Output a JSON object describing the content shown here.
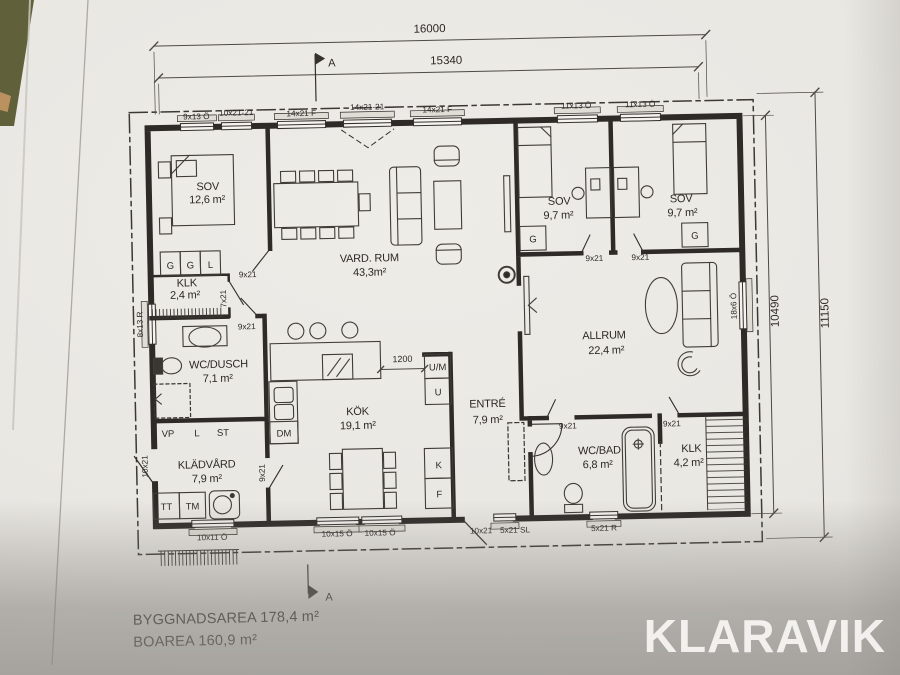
{
  "photo": {
    "watermark": "KLARAVIK"
  },
  "notes": {
    "byggnadsarea_line": "BYGGNADSAREA 178,4 m²",
    "boarea_line": "BOAREA 160,9 m²"
  },
  "section": {
    "label": "A"
  },
  "dims": {
    "top_outer": "16000",
    "top_inner": "15340",
    "right_inner": "10490",
    "right_outer": "11150",
    "kitchen_opening": "1200"
  },
  "rooms": {
    "sov1": {
      "name": "SOV",
      "area": "12,6 m²"
    },
    "klk1": {
      "name": "KLK",
      "area": "2,4 m²"
    },
    "vardrum": {
      "name": "VARD. RUM",
      "area": "43,3m²"
    },
    "sov2": {
      "name": "SOV",
      "area": "9,7 m²"
    },
    "sov3": {
      "name": "SOV",
      "area": "9,7 m²"
    },
    "allrum": {
      "name": "ALLRUM",
      "area": "22,4 m²"
    },
    "wcdusch": {
      "name": "WC/DUSCH",
      "area": "7,1 m²"
    },
    "kok": {
      "name": "KÖK",
      "area": "19,1 m²"
    },
    "entre": {
      "name": "ENTRÉ",
      "area": "7,9 m²"
    },
    "wcbad": {
      "name": "WC/BAD",
      "area": "6,8 m²"
    },
    "klk2": {
      "name": "KLK",
      "area": "4,2 m²"
    },
    "kladvard": {
      "name": "KLÄDVÅRD",
      "area": "7,9 m²"
    }
  },
  "openings": {
    "top": [
      "9x13 Ö",
      "10x21-21",
      "14x21 F",
      "14x21-21",
      "14x21 F",
      "11x13 Ö",
      "11x13 Ö"
    ],
    "bottom": [
      "10x11 Ö",
      "10x15 Ö",
      "10x15 Ö",
      "10x21",
      "5x21 SL",
      "5x21 R"
    ],
    "left": [
      "8x13 R",
      "10x21"
    ],
    "right": [
      "18x6 Ö"
    ],
    "doors": {
      "d9x21": "9x21",
      "d7x21": "7x21"
    }
  },
  "fixtures": {
    "g": "G",
    "l": "L",
    "vp": "VP",
    "st": "ST",
    "tt": "TT",
    "tm": "TM",
    "dm": "DM",
    "um": "U/M",
    "u": "U",
    "k": "K",
    "f": "F"
  }
}
